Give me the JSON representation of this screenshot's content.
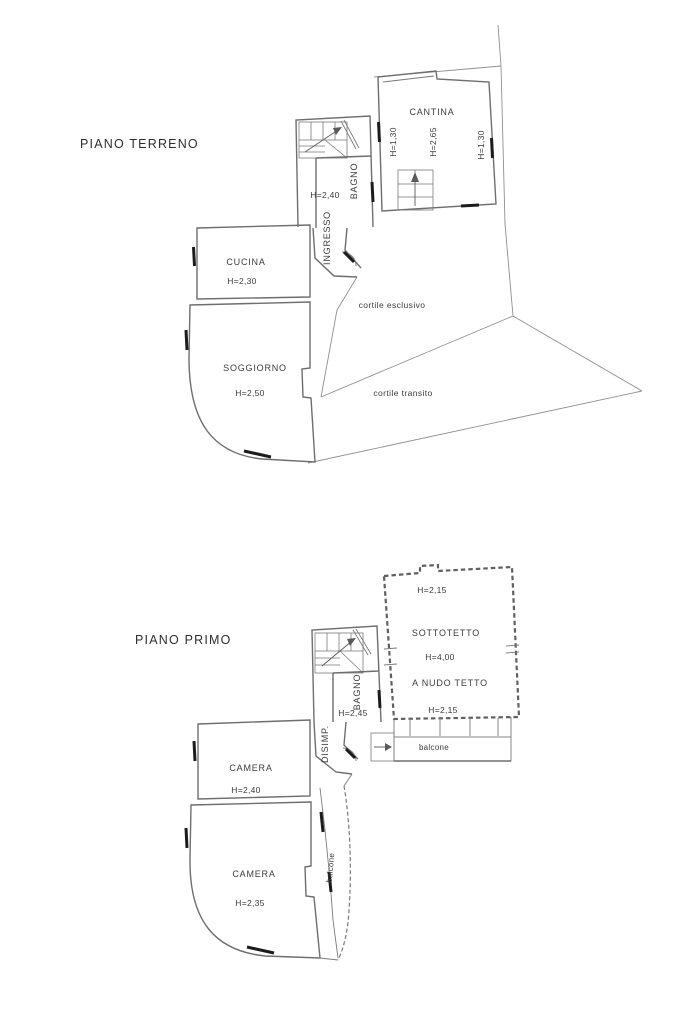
{
  "page": {
    "background": "#ffffff",
    "line_color": "#6e6e6e",
    "boundary_color": "#8f8f8f",
    "text_color": "#3c3c3c",
    "window_mark_color": "#1c1c1c"
  },
  "ground_floor": {
    "title": "PIANO TERRENO",
    "cantina": {
      "label": "CANTINA",
      "h_left": "H=1,30",
      "h_center": "H=2,65",
      "h_right": "H=1,30"
    },
    "bagno": {
      "label": "BAGNO",
      "h": "H=2,40"
    },
    "ingresso": {
      "label": "INGRESSO"
    },
    "cucina": {
      "label": "CUCINA",
      "h": "H=2,30"
    },
    "soggiorno": {
      "label": "SOGGIORNO",
      "h": "H=2,50"
    },
    "cortile_esclusivo": {
      "label": "cortile esclusivo"
    },
    "cortile_transito": {
      "label": "cortile transito"
    }
  },
  "first_floor": {
    "title": "PIANO PRIMO",
    "sottotetto": {
      "label": "SOTTOTETTO",
      "h_top": "H=2,15",
      "h_center": "H=4,00",
      "note": "A NUDO TETTO",
      "h_bottom": "H=2,15"
    },
    "bagno": {
      "label": "BAGNO",
      "h": "H=2,45"
    },
    "disimpegno": {
      "label": "DISIMP."
    },
    "camera_1": {
      "label": "CAMERA",
      "h": "H=2,40"
    },
    "camera_2": {
      "label": "CAMERA",
      "h": "H=2,35"
    },
    "balcone_front": {
      "label": "balcone"
    },
    "balcone_side": {
      "label": "balcone"
    }
  }
}
